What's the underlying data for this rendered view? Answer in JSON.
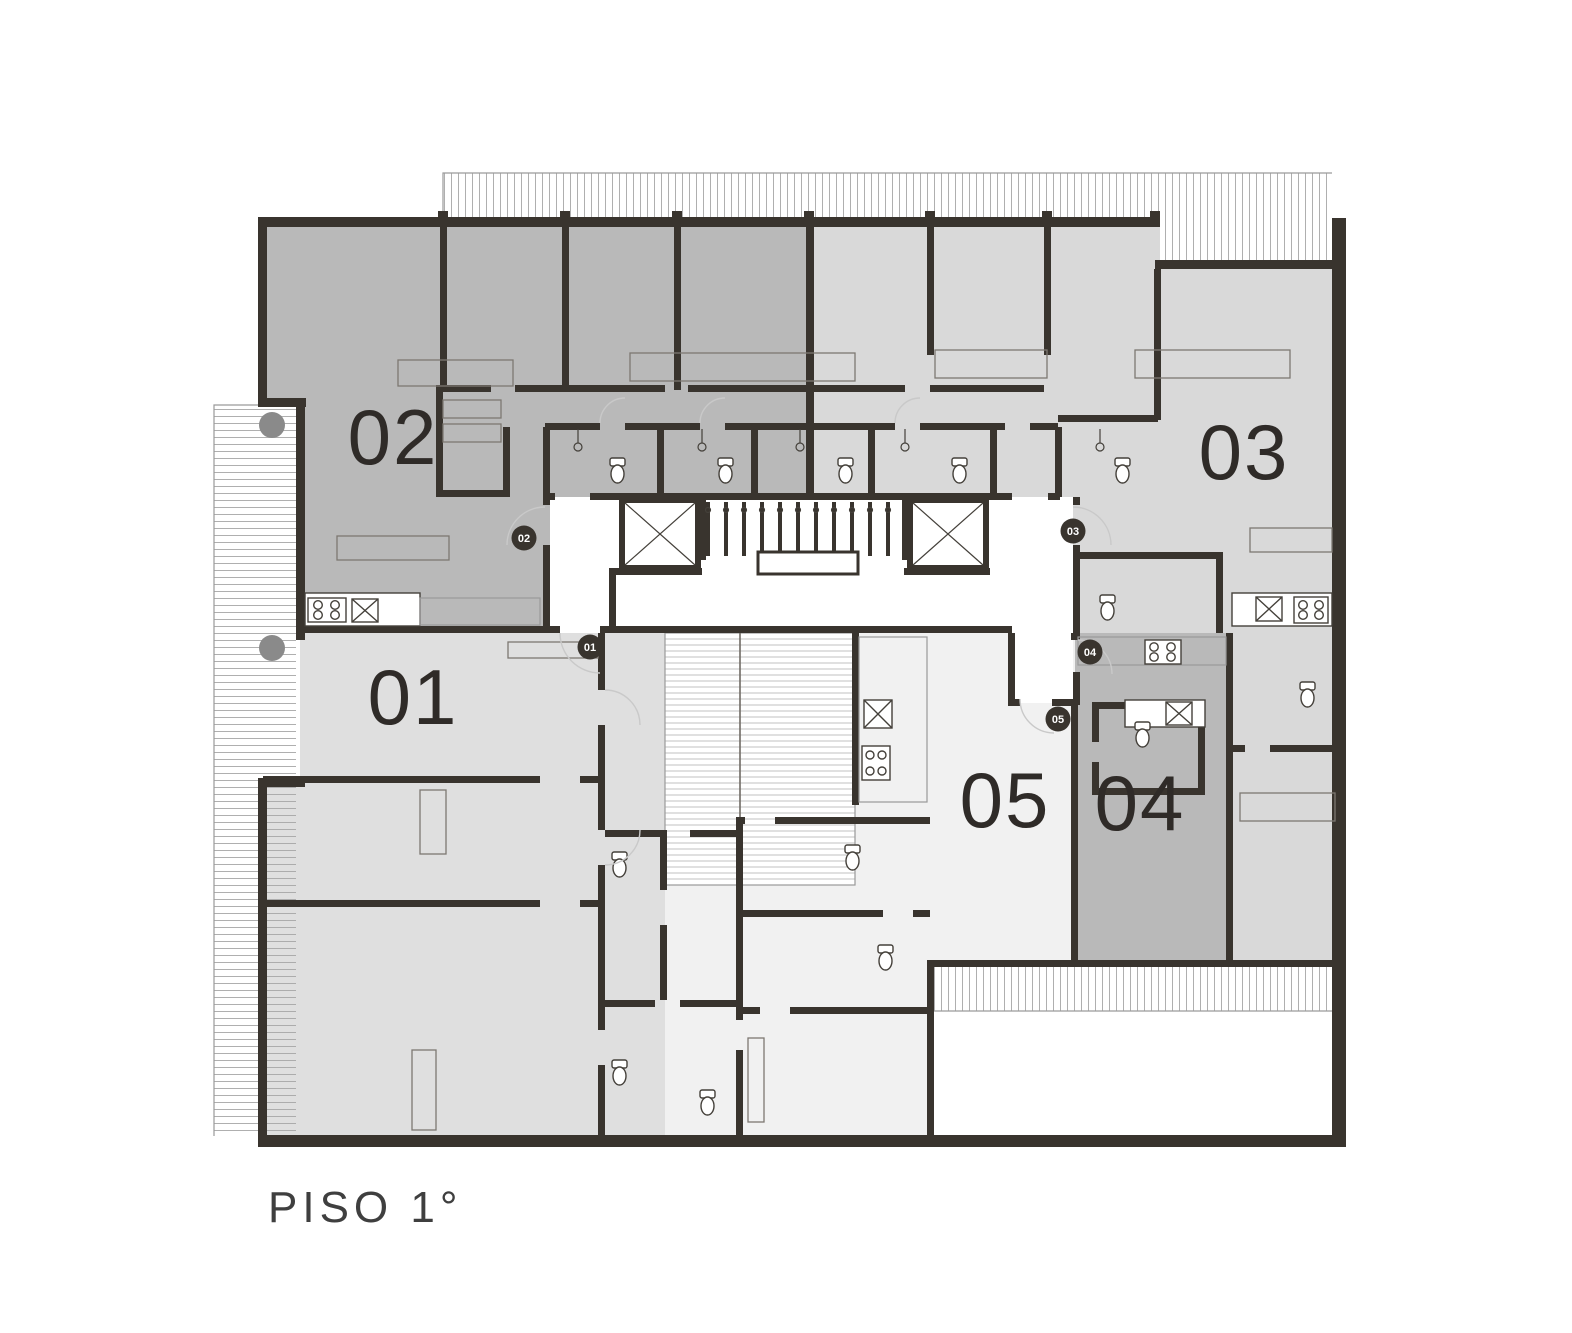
{
  "floor": {
    "title": "PISO 1°"
  },
  "units": {
    "u01": {
      "label": "01",
      "badge": "01",
      "color": "#dfdfdf"
    },
    "u02": {
      "label": "02",
      "badge": "02",
      "color": "#b9b9b9"
    },
    "u03": {
      "label": "03",
      "badge": "03",
      "color": "#d9d9d9"
    },
    "u04": {
      "label": "04",
      "badge": "04",
      "color": "#b9b9b9"
    },
    "u05": {
      "label": "05",
      "badge": "05",
      "color": "#f1f1f1"
    }
  },
  "colors": {
    "background": "#ffffff",
    "wall": "#39342e",
    "corridor": "#ffffff",
    "terrace": "#ffffff",
    "deck": "#ffffff",
    "column": "#8a8a8a",
    "label_text": "#2f2b28",
    "badge_bg": "#39342e",
    "badge_text": "#ffffff",
    "title_text": "#3f3f3f"
  }
}
